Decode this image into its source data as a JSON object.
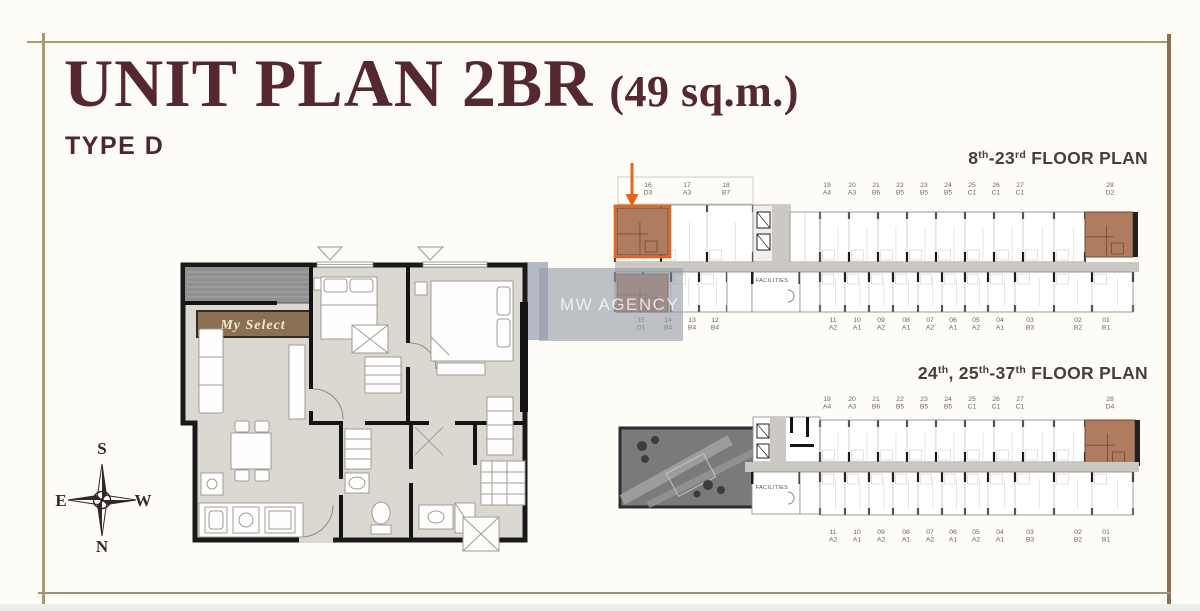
{
  "header": {
    "title": "UNIT PLAN 2BR",
    "area": "(49 sq.m.)",
    "type": "TYPE D"
  },
  "compass": {
    "top": "S",
    "bottom": "N",
    "left": "E",
    "right": "W"
  },
  "unit_plan": {
    "banner": "My Select"
  },
  "watermark": {
    "text": "MW AGENCY"
  },
  "floor_plans": [
    {
      "title_parts": [
        {
          "t": "8"
        },
        {
          "t": "th",
          "sup": true
        },
        {
          "t": "-23"
        },
        {
          "t": "rd",
          "sup": true
        },
        {
          "t": " FLOOR PLAN"
        }
      ],
      "facilities": "FACILITIES",
      "top_units": [
        {
          "no": "16",
          "type": "D3",
          "highlight": true,
          "boxed": true
        },
        {
          "no": "17",
          "type": "A3"
        },
        {
          "no": "18",
          "type": "B7"
        },
        {
          "no": "19",
          "type": "A4"
        },
        {
          "no": "20",
          "type": "A3"
        },
        {
          "no": "21",
          "type": "B6"
        },
        {
          "no": "22",
          "type": "B5"
        },
        {
          "no": "23",
          "type": "B5"
        },
        {
          "no": "24",
          "type": "B5"
        },
        {
          "no": "25",
          "type": "C1"
        },
        {
          "no": "26",
          "type": "C1"
        },
        {
          "no": "27",
          "type": "C1"
        },
        {
          "no": "28",
          "type": "D2",
          "highlight": true
        }
      ],
      "bottom_units": [
        {
          "no": "15",
          "type": "D1",
          "highlight": true
        },
        {
          "no": "14",
          "type": "B4"
        },
        {
          "no": "13",
          "type": "B4"
        },
        {
          "no": "12",
          "type": "B4"
        },
        {
          "no": "11",
          "type": "A2"
        },
        {
          "no": "10",
          "type": "A1"
        },
        {
          "no": "09",
          "type": "A2"
        },
        {
          "no": "08",
          "type": "A1"
        },
        {
          "no": "07",
          "type": "A2"
        },
        {
          "no": "06",
          "type": "A1"
        },
        {
          "no": "05",
          "type": "A2"
        },
        {
          "no": "04",
          "type": "A1"
        },
        {
          "no": "03",
          "type": "B3"
        },
        {
          "no": "02",
          "type": "B2"
        },
        {
          "no": "01",
          "type": "B1"
        }
      ]
    },
    {
      "title_parts": [
        {
          "t": "24"
        },
        {
          "t": "th",
          "sup": true
        },
        {
          "t": ", 25"
        },
        {
          "t": "th",
          "sup": true
        },
        {
          "t": "-37"
        },
        {
          "t": "th",
          "sup": true
        },
        {
          "t": " FLOOR PLAN"
        }
      ],
      "facilities": "FACILITIES",
      "top_units": [
        {
          "no": "19",
          "type": "A4"
        },
        {
          "no": "20",
          "type": "A3"
        },
        {
          "no": "21",
          "type": "B6"
        },
        {
          "no": "22",
          "type": "B5"
        },
        {
          "no": "23",
          "type": "B5"
        },
        {
          "no": "24",
          "type": "B5"
        },
        {
          "no": "25",
          "type": "C1"
        },
        {
          "no": "26",
          "type": "C1"
        },
        {
          "no": "27",
          "type": "C1"
        },
        {
          "no": "28",
          "type": "D4",
          "highlight": true
        }
      ],
      "bottom_units": [
        {
          "no": "11",
          "type": "A2"
        },
        {
          "no": "10",
          "type": "A1"
        },
        {
          "no": "09",
          "type": "A2"
        },
        {
          "no": "08",
          "type": "A1"
        },
        {
          "no": "07",
          "type": "A2"
        },
        {
          "no": "06",
          "type": "A1"
        },
        {
          "no": "05",
          "type": "A2"
        },
        {
          "no": "04",
          "type": "A1"
        },
        {
          "no": "03",
          "type": "B3"
        },
        {
          "no": "02",
          "type": "B2"
        },
        {
          "no": "01",
          "type": "B1"
        }
      ]
    }
  ],
  "colors": {
    "accent_orange": "#e2661b",
    "highlight_brown": "#b07c60",
    "title_maroon": "#55272e",
    "frame_tan": "#a89c68",
    "frame_brown": "#8a6f4e"
  }
}
